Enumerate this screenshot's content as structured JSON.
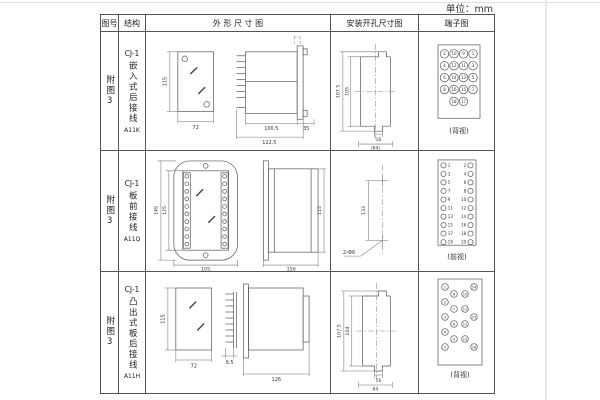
{
  "unit_label": "单位：mm",
  "headers": {
    "fig_no": "图号",
    "structure": "结构",
    "outline": "外 形 尺 寸 图",
    "mounting": "安装开孔尺寸图",
    "terminal": "端子图"
  },
  "rows": [
    {
      "fig_no": "附图3",
      "model": "CJ-1",
      "type": "嵌入式后接线",
      "code": "A11K",
      "outline": {
        "front_height": "115",
        "front_width": "72",
        "side_width": "100.5",
        "side_total": "122.5",
        "panel_depth": "35"
      },
      "mounting": {
        "outer_height": "107.5",
        "inner_height": "105",
        "slot_width": "16",
        "span": "(64)"
      },
      "terminal": {
        "view_label": "(背视)",
        "rows": [
          [
            2,
            10,
            9,
            1
          ],
          [
            4,
            12,
            11,
            3
          ],
          [
            6,
            14,
            13,
            5
          ],
          [
            8,
            16,
            15,
            7
          ],
          [
            18,
            17
          ]
        ]
      }
    },
    {
      "fig_no": "附图3",
      "model": "CJ-1",
      "type": "板前接线",
      "code": "A11Q",
      "outline": {
        "front_outer_height": "149",
        "front_inner_height": "125",
        "front_width": "105",
        "side_width": "156",
        "side_height": "115"
      },
      "mounting": {
        "hole_span": "133",
        "hole_label": "2-Φ6"
      },
      "terminal": {
        "view_label": "(前视)",
        "left": [
          1,
          3,
          5,
          7,
          9,
          11,
          13,
          15,
          17,
          19
        ],
        "right": [
          2,
          4,
          6,
          8,
          10,
          12,
          14,
          16,
          18,
          20
        ]
      }
    },
    {
      "fig_no": "附图3",
      "model": "CJ-1",
      "type": "凸出式板后接线",
      "code": "A11H",
      "outline": {
        "front_height": "115",
        "front_width": "72",
        "pin_pitch": "9.5",
        "side_width": "126"
      },
      "mounting": {
        "outer_height": "107.5",
        "inner_height": "104",
        "slot_width": "16",
        "span": "64"
      },
      "terminal": {
        "view_label": "(背视)",
        "numbers": [
          1,
          2,
          3,
          4,
          5,
          6,
          7,
          8,
          9,
          10,
          11,
          12,
          13,
          14,
          15,
          16
        ]
      }
    }
  ]
}
